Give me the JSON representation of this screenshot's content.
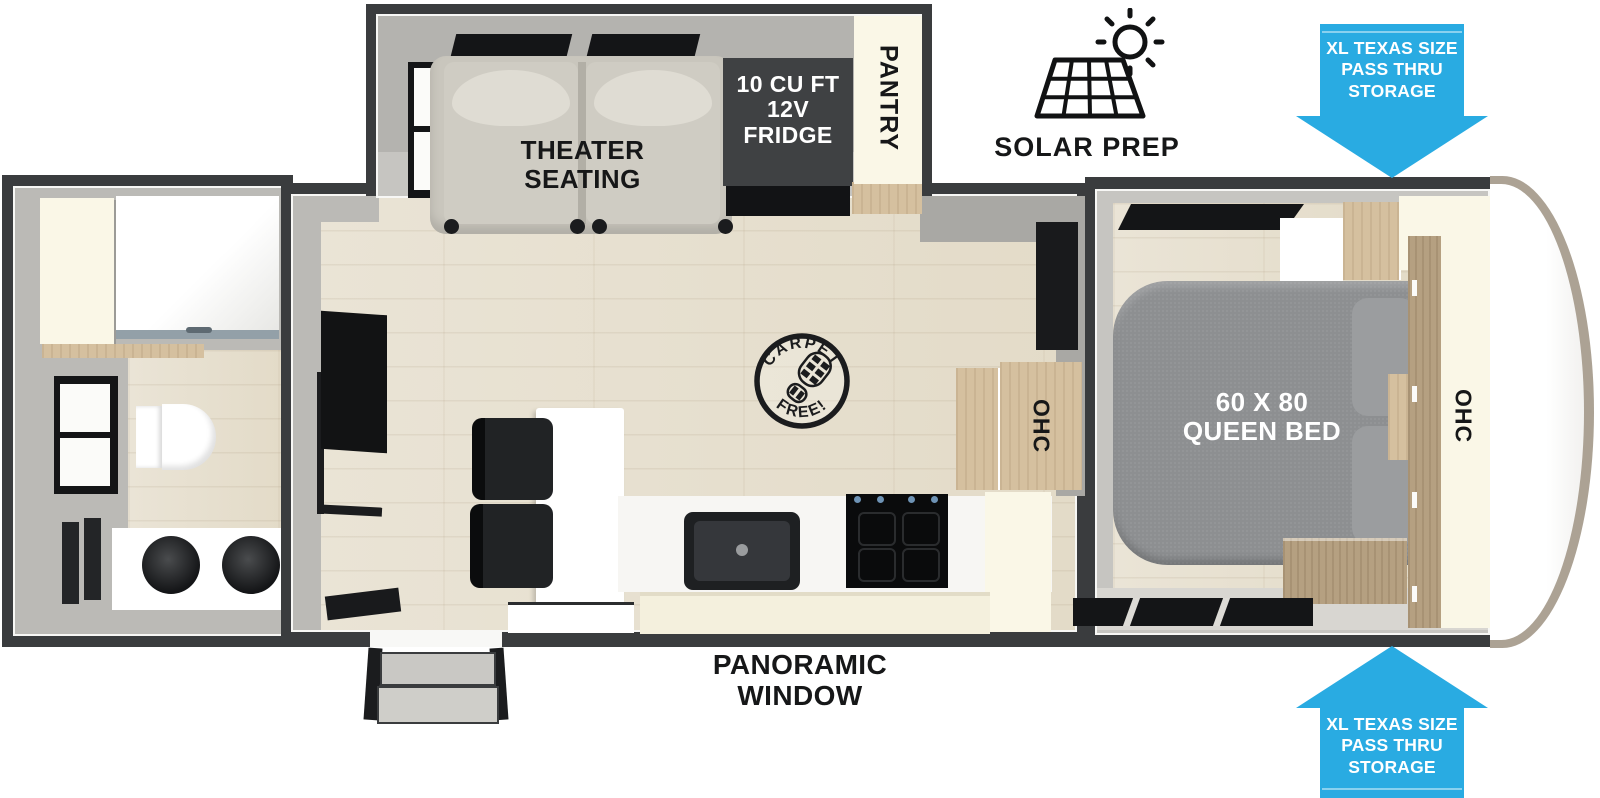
{
  "labels": {
    "theater_seating": "THEATER\nSEATING",
    "fridge": "10 CU FT\n12V\nFRIDGE",
    "pantry": "PANTRY",
    "solar_prep": "SOLAR PREP",
    "pass_thru_storage_top": "XL TEXAS SIZE\nPASS THRU\nSTORAGE",
    "pass_thru_storage_bottom": "XL TEXAS SIZE\nPASS THRU\nSTORAGE",
    "queen_bed": "60 X 80\nQUEEN BED",
    "ohc_kitchen": "OHC",
    "ohc_bedroom": "OHC",
    "panoramic_window": "PANORAMIC\nWINDOW",
    "carpet_free_top": "CARPET",
    "carpet_free_bottom": "FREE!"
  },
  "icons": {
    "solar_panel": "solar-panel-grid-with-sun",
    "pass_thru_top": "down-arrow",
    "pass_thru_bottom": "up-arrow",
    "carpet_free": "boot-print-stamp"
  },
  "colors": {
    "arrow_blue": "#29ABE2",
    "wall_dark": "#3A3C3E",
    "wall_gray": "#BBBAB6",
    "cream": "#FAF7E7",
    "wood_cabinet": "#D5C09F",
    "wood_dark": "#B5A081",
    "bed_gray": "#8D8F91",
    "seat_beige": "#C9C6BD",
    "fridge_gray": "#3F4143",
    "line_black": "#141517"
  }
}
